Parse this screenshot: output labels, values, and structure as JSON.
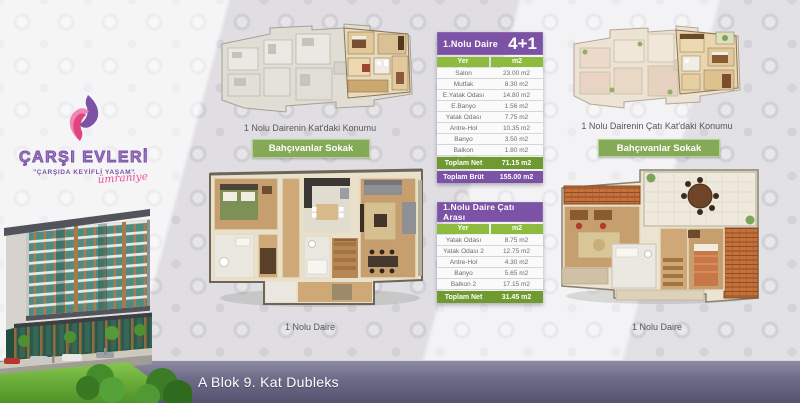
{
  "brand": {
    "title": "ÇARŞI EVLERİ",
    "tagline": "\"ÇARŞIDA KEYİFLİ YAŞAM\"",
    "signature": "ümraniye"
  },
  "plans": {
    "floor_location": {
      "caption": "1 Nolu Dairenin Kat'daki Konumu",
      "street": "Bahçıvanlar Sokak"
    },
    "roof_location": {
      "caption": "1 Nolu Dairenin Çatı Kat'daki Konumu",
      "street": "Bahçıvanlar Sokak"
    },
    "main_unit": {
      "caption": "1 Nolu Daire"
    },
    "attic_unit": {
      "caption": "1 Nolu Daire"
    }
  },
  "table_main": {
    "title": "1.Nolu Daire",
    "badge": "4+1",
    "columns": [
      "Yer",
      "m2"
    ],
    "rows": [
      [
        "Salon",
        "23.00 m2"
      ],
      [
        "Mutfak",
        "8.30 m2"
      ],
      [
        "E.Yatak Odası",
        "14.80 m2"
      ],
      [
        "E.Banyo",
        "1.56 m2"
      ],
      [
        "Yatak Odası",
        "7.75 m2"
      ],
      [
        "Antre-Hol",
        "10.35 m2"
      ],
      [
        "Banyo",
        "3.50 m2"
      ],
      [
        "Balkon",
        "1.80 m2"
      ]
    ],
    "total_net_label": "Toplam Net",
    "total_net_value": "71.15 m2",
    "total_gross_label": "Toplam Brüt",
    "total_gross_value": "155.00 m2"
  },
  "table_attic": {
    "title": "1.Nolu Daire Çatı Arası",
    "columns": [
      "Yer",
      "m2"
    ],
    "rows": [
      [
        "Yatak Odası",
        "8.75 m2"
      ],
      [
        "Yatak Odası 2",
        "12.75 m2"
      ],
      [
        "Antre-Hol",
        "4.30 m2"
      ],
      [
        "Banyo",
        "5.65 m2"
      ],
      [
        "Balkon 2",
        "17.15 m2"
      ]
    ],
    "total_net_label": "Toplam Net",
    "total_net_value": "31.45 m2"
  },
  "footer": {
    "label": "A Blok 9. Kat Dubleks"
  },
  "colors": {
    "purple": "#7b52a5",
    "green_header": "#8dbb3d",
    "green_total": "#6f9a2f",
    "button_green": "#84a957",
    "footer_top": "#8e8ca3",
    "footer_bottom": "#555270",
    "accent_pink": "#e5559a"
  }
}
